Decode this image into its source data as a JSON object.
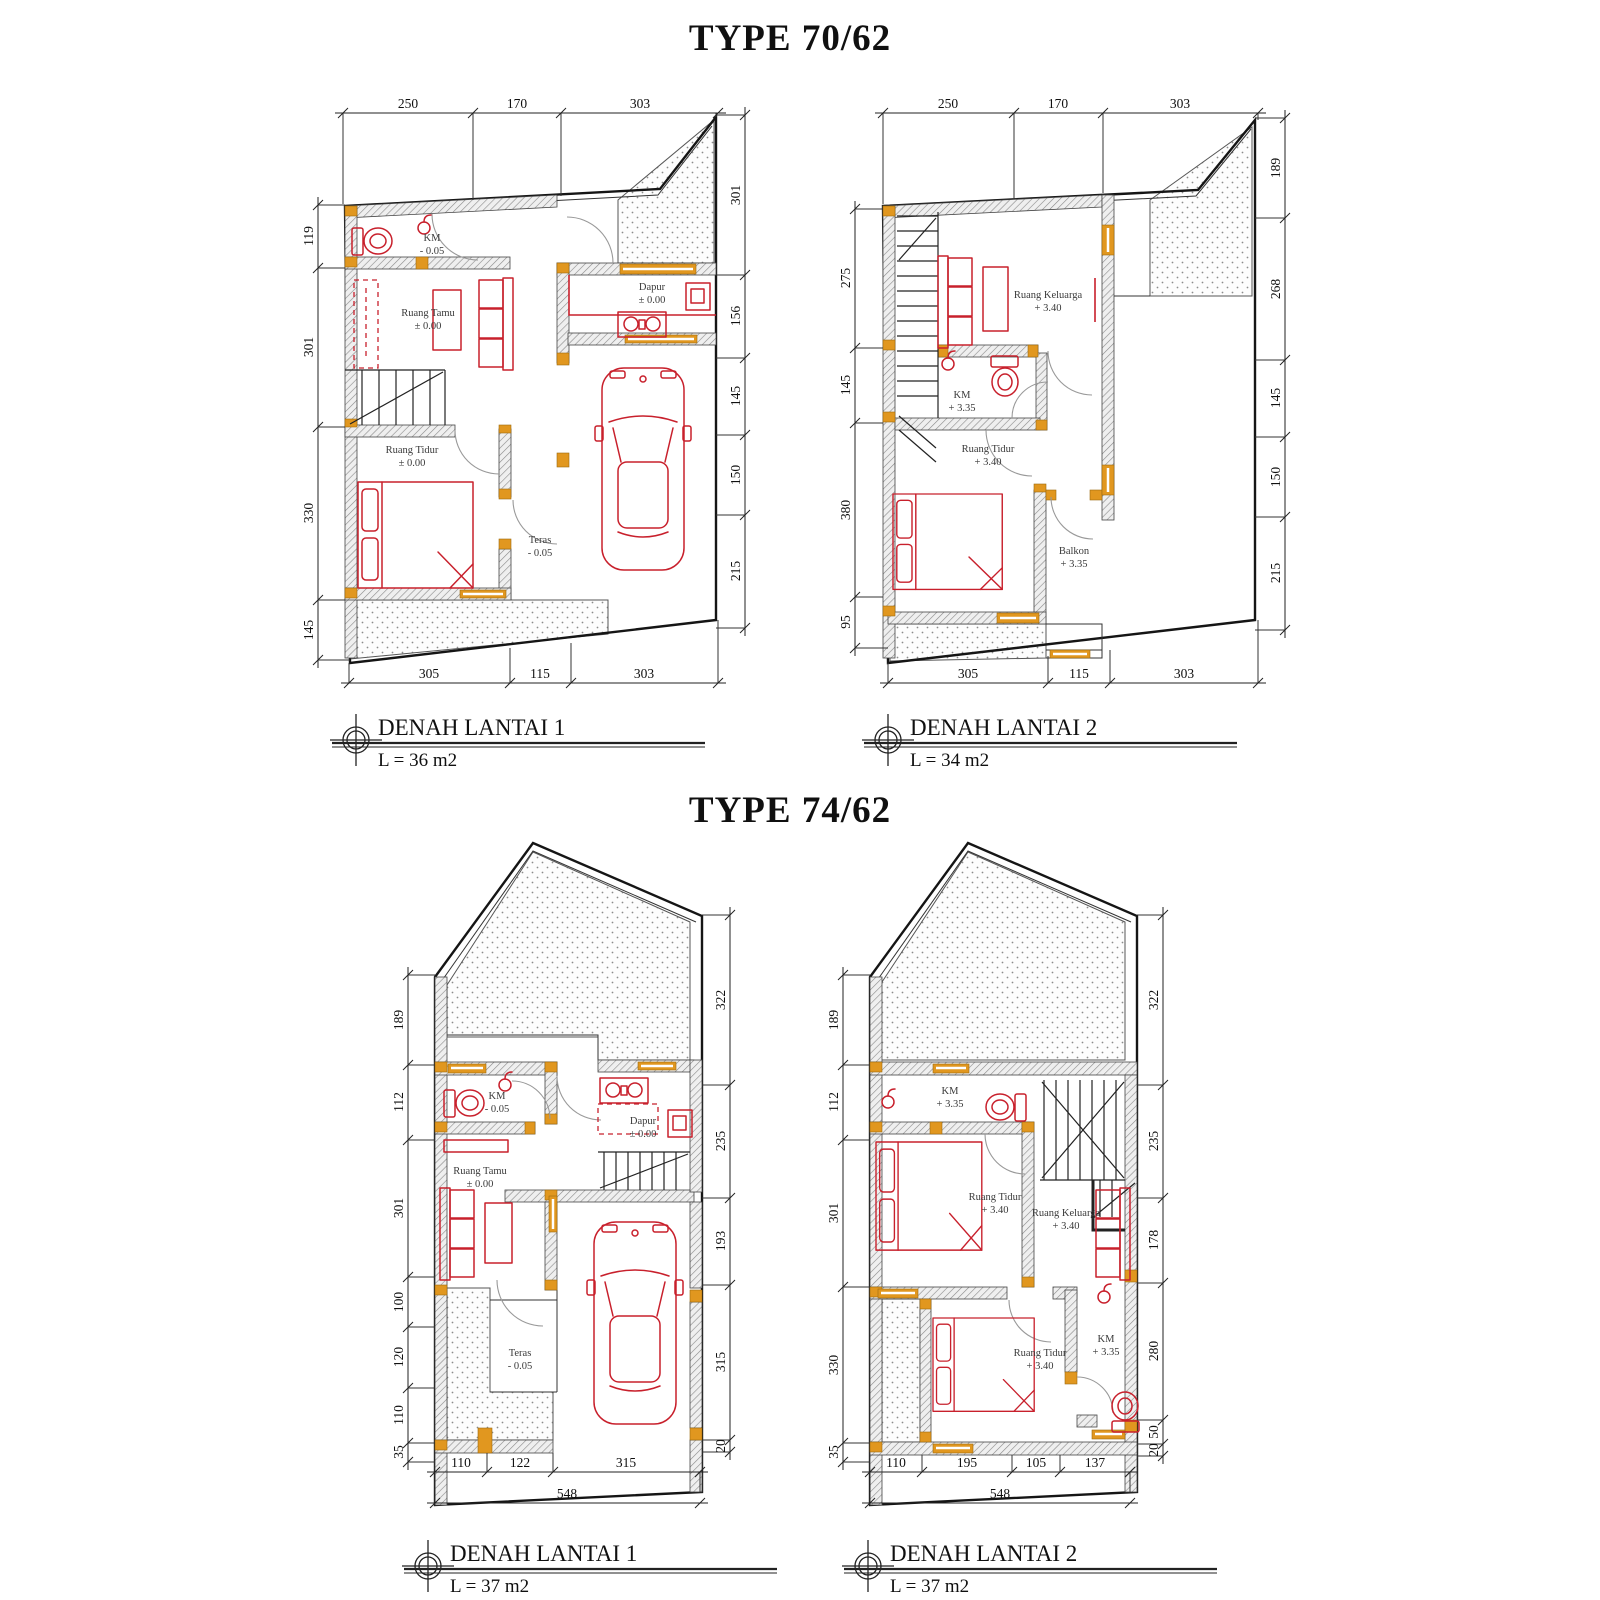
{
  "sections": [
    {
      "title": "TYPE 70/62",
      "plans": [
        {
          "label": "DENAH LANTAI 1",
          "area": "L = 36 m2",
          "rooms": [
            {
              "name": "KM",
              "elev": "- 0.05"
            },
            {
              "name": "Ruang Tamu",
              "elev": "± 0.00"
            },
            {
              "name": "Dapur",
              "elev": "± 0.00"
            },
            {
              "name": "Ruang Tidur",
              "elev": "± 0.00"
            },
            {
              "name": "Teras",
              "elev": "- 0.05"
            }
          ],
          "dims": {
            "top": [
              "250",
              "170",
              "303"
            ],
            "left": [
              "119",
              "301",
              "330",
              "145"
            ],
            "right": [
              "301",
              "156",
              "145",
              "150",
              "215"
            ],
            "bottom": [
              "305",
              "115",
              "303"
            ]
          }
        },
        {
          "label": "DENAH LANTAI 2",
          "area": "L = 34 m2",
          "rooms": [
            {
              "name": "Ruang Keluarga",
              "elev": "+ 3.40"
            },
            {
              "name": "KM",
              "elev": "+ 3.35"
            },
            {
              "name": "Ruang Tidur",
              "elev": "+ 3.40"
            },
            {
              "name": "Balkon",
              "elev": "+ 3.35"
            }
          ],
          "dims": {
            "top": [
              "250",
              "170",
              "303"
            ],
            "left": [
              "275",
              "145",
              "380",
              "95"
            ],
            "right": [
              "189",
              "268",
              "145",
              "150",
              "215"
            ],
            "bottom": [
              "305",
              "115",
              "303"
            ]
          }
        }
      ]
    },
    {
      "title": "TYPE 74/62",
      "plans": [
        {
          "label": "DENAH LANTAI 1",
          "area": "L = 37 m2",
          "rooms": [
            {
              "name": "KM",
              "elev": "- 0.05"
            },
            {
              "name": "Dapur",
              "elev": "± 0.00"
            },
            {
              "name": "Ruang Tamu",
              "elev": "± 0.00"
            },
            {
              "name": "Teras",
              "elev": "- 0.05"
            }
          ],
          "dims": {
            "left": [
              "189",
              "112",
              "301",
              "100",
              "120",
              "110",
              "35"
            ],
            "right": [
              "322",
              "235",
              "193",
              "315",
              "20"
            ],
            "bottom": [
              "110",
              "122",
              "315"
            ],
            "overall": [
              "548"
            ]
          }
        },
        {
          "label": "DENAH LANTAI 2",
          "area": "L = 37 m2",
          "rooms": [
            {
              "name": "KM",
              "elev": "+ 3.35"
            },
            {
              "name": "Ruang Tidur",
              "elev": "+ 3.40"
            },
            {
              "name": "Ruang Keluarga",
              "elev": "+ 3.40"
            },
            {
              "name": "Ruang Tidur",
              "elev": "+ 3.40"
            },
            {
              "name": "KM",
              "elev": "+ 3.35"
            }
          ],
          "dims": {
            "left": [
              "189",
              "112",
              "301",
              "330",
              "35"
            ],
            "right": [
              "322",
              "235",
              "178",
              "280",
              "50",
              "20"
            ],
            "bottom": [
              "110",
              "195",
              "105",
              "137"
            ],
            "overall": [
              "548"
            ]
          }
        }
      ]
    }
  ],
  "colors": {
    "furniture_red": "#c8202c",
    "frame_orange": "#e1971f",
    "wall_dark": "#444444",
    "stipple_gray": "#8c8c8c"
  }
}
